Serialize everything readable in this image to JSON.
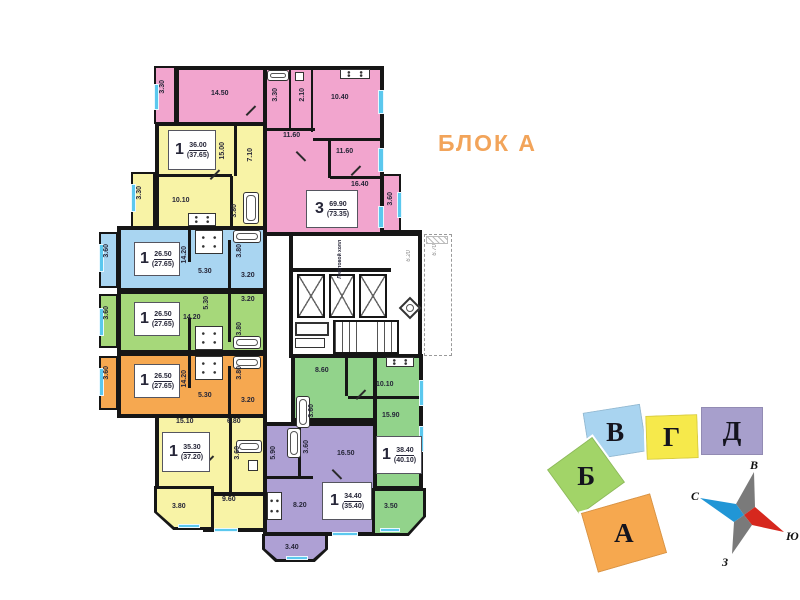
{
  "block_title": "БЛОК А",
  "core": {
    "elevator_hall": "Лифтовой холл",
    "corridor_width": "6.20",
    "outside_width": "6.70"
  },
  "apartments": {
    "pink": {
      "rooms_count": "3",
      "area": "69.90",
      "area_total": "(73.35)",
      "labels": {
        "balcony_tl": "3.30",
        "living": "14.50",
        "bath": "3.30",
        "wc": "2.10",
        "kitchen": "10.40",
        "bedroom1": "11.60",
        "bedroom2": "11.60",
        "bedroom3": "16.40",
        "balcony_r": "3.60"
      }
    },
    "yellow_top": {
      "rooms_count": "1",
      "area": "36.00",
      "area_total": "(37.65)",
      "labels": {
        "room": "15.00",
        "hall": "7.10",
        "kitchen": "10.10",
        "bath": "3.80",
        "balcony": "3.30"
      }
    },
    "blue": {
      "rooms_count": "1",
      "area": "26.50",
      "area_total": "(27.65)",
      "labels": {
        "balcony": "3.60",
        "room": "14.20",
        "kitchen": "5.30",
        "bath": "3.80",
        "hall": "3.20"
      }
    },
    "green": {
      "rooms_count": "1",
      "area": "26.50",
      "area_total": "(27.65)",
      "labels": {
        "balcony": "3.60",
        "room": "14.20",
        "kitchen": "5.30",
        "bath": "3.80",
        "hall": "3.20"
      }
    },
    "orange": {
      "rooms_count": "1",
      "area": "26.50",
      "area_total": "(27.65)",
      "labels": {
        "balcony": "3.60",
        "room": "14.20",
        "kitchen": "5.30",
        "bath": "3.80",
        "hall": "3.20"
      }
    },
    "yellow_bottom": {
      "rooms_count": "1",
      "area": "35.30",
      "area_total": "(37.20)",
      "labels": {
        "room1": "15.10",
        "room2": "6.80",
        "bath": "3.60",
        "kitchen": "9.60",
        "balcony": "3.80"
      }
    },
    "purple": {
      "rooms_count": "1",
      "area": "34.40",
      "area_total": "(35.40)",
      "labels": {
        "hall": "5.90",
        "bath": "3.60",
        "room": "16.50",
        "kitchen": "8.20",
        "balcony": "3.40"
      }
    },
    "green_bottom": {
      "rooms_count": "1",
      "area": "38.40",
      "area_total": "(40.10)",
      "labels": {
        "kitchen": "8.60",
        "room1": "10.10",
        "room2": "15.90",
        "bath": "3.60",
        "balcony": "3.50"
      }
    }
  },
  "site_map": {
    "blocks": [
      {
        "label": "В",
        "color": "#a9d4f0"
      },
      {
        "label": "Г",
        "color": "#f6e94b"
      },
      {
        "label": "Д",
        "color": "#a79fcc"
      },
      {
        "label": "Б",
        "color": "#a2d468"
      },
      {
        "label": "А",
        "color": "#f6a84f"
      }
    ]
  },
  "compass": {
    "east": "В",
    "north": "С",
    "south": "Ю",
    "west": "З"
  },
  "colors": {
    "pink": "#f2a5ce",
    "yellow": "#f8f3a6",
    "blue": "#a9d5f1",
    "green": "#a6d87a",
    "orange": "#f6a850",
    "purple": "#aea0d4",
    "green_bottom": "#92d38b",
    "accent_title": "#f2a45a",
    "wall": "#161616",
    "window": "#5bc8ee",
    "compass_red": "#d6281e",
    "compass_blue": "#2196d6",
    "compass_gray": "#7a7a7a"
  }
}
